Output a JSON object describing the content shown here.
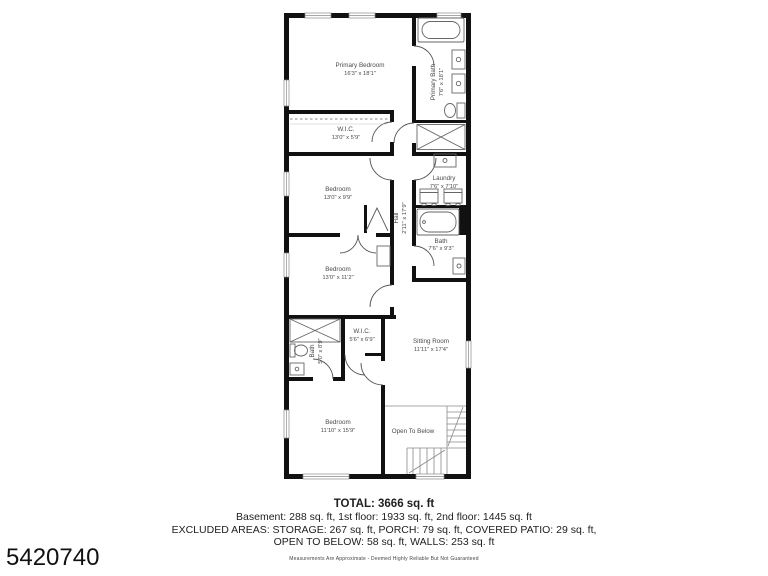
{
  "page": {
    "background": "#ffffff",
    "wall_color": "#111111",
    "fixture_line_color": "#666666",
    "label_color": "#4a4a4a",
    "listing_id": "5420740"
  },
  "rooms": {
    "primary_bedroom": {
      "name": "Primary Bedroom",
      "dims": "16'3\" x 18'1\""
    },
    "primary_bath": {
      "name": "Primary Bath",
      "dims": "7'6\" x 18'1\""
    },
    "wic_upper": {
      "name": "W.I.C.",
      "dims": "13'0\" x 5'9\""
    },
    "bedroom_2": {
      "name": "Bedroom",
      "dims": "13'0\" x 9'9\""
    },
    "hall": {
      "name": "Hall",
      "dims": "2'11\" x 17'9\""
    },
    "laundry": {
      "name": "Laundry",
      "dims": "7'6\" x 7'10\""
    },
    "bath_hall": {
      "name": "Bath",
      "dims": "7'6\" x 9'3\""
    },
    "bedroom_3": {
      "name": "Bedroom",
      "dims": "13'0\" x 11'2\""
    },
    "bath_small": {
      "name": "Bath",
      "dims": "5'0\" x 8'9\""
    },
    "wic_lower": {
      "name": "W.I.C.",
      "dims": "5'6\" x 6'9\""
    },
    "sitting_room": {
      "name": "Sitting Room",
      "dims": "11'11\" x 17'4\""
    },
    "bedroom_4": {
      "name": "Bedroom",
      "dims": "11'10\" x 15'9\""
    },
    "open_to_below": {
      "name": "Open To Below"
    }
  },
  "summary": {
    "total": "TOTAL: 3666 sq. ft",
    "line1": "Basement: 288 sq. ft, 1st floor: 1933 sq. ft, 2nd floor: 1445 sq. ft",
    "line2": "EXCLUDED AREAS: STORAGE: 267 sq. ft, PORCH: 79 sq. ft, COVERED PATIO: 29 sq. ft,",
    "line3": "OPEN TO BELOW: 58 sq. ft, WALLS: 253 sq. ft",
    "disclaimer": "Measurements Are Approximate - Deemed Highly Reliable But Not Guaranteed"
  }
}
